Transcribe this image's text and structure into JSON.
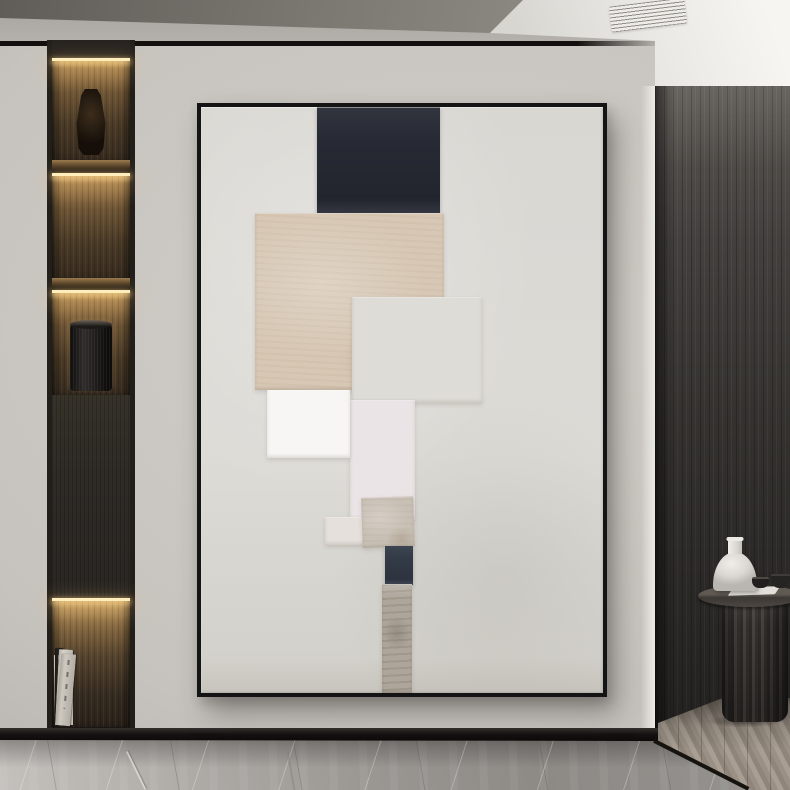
{
  "scene": {
    "type": "interior-photograph",
    "objects": [
      "framed-abstract-painting",
      "recessed-display-shelf",
      "dark-glass-vase",
      "black-cylinder-speaker",
      "book-row",
      "round-pedestal-side-table",
      "white-bottle-vase",
      "paper-sheet",
      "small-dark-bowls",
      "ceiling-air-vent"
    ]
  },
  "palette": {
    "wall": "#c9c6c1",
    "ceiling_dark": "#6e6b66",
    "ceiling_white": "#f2f0ed",
    "wood_wall": "#3c3936",
    "shelf_glow": "#d3ad6e",
    "baseboard": "#141210",
    "marble_floor": "#a09d99",
    "chevron_floor": "#9a9085",
    "frame": "#141414",
    "canvas": "#dbd9d4"
  },
  "painting": {
    "frame_color": "#141414",
    "canvas_color": "#dbd9d4",
    "blocks": [
      {
        "id": "navy-top",
        "left": 28.9,
        "top": 0.0,
        "width": 30.6,
        "height": 18.4,
        "color": "#272a34",
        "cls": "b-navy",
        "rot": 0
      },
      {
        "id": "beige-large",
        "left": 13.4,
        "top": 18.1,
        "width": 47.0,
        "height": 30.2,
        "color": "#d7c7b4",
        "cls": "b-paper",
        "rot": 0
      },
      {
        "id": "gray-square",
        "left": 37.6,
        "top": 32.4,
        "width": 32.3,
        "height": 18.1,
        "color": "#dedcd7",
        "cls": "",
        "rot": 0
      },
      {
        "id": "pale-rect",
        "left": 37.1,
        "top": 50.0,
        "width": 16.2,
        "height": 20.5,
        "color": "#eae4e6",
        "cls": "",
        "rot": 0
      },
      {
        "id": "white-square",
        "left": 16.4,
        "top": 48.3,
        "width": 20.6,
        "height": 11.6,
        "color": "#f7f6f4",
        "cls": "",
        "rot": 0
      },
      {
        "id": "small-pale",
        "left": 30.8,
        "top": 70.0,
        "width": 11.2,
        "height": 4.8,
        "color": "#e5e0dc",
        "cls": "",
        "rot": 0
      },
      {
        "id": "tan-square",
        "left": 40.0,
        "top": 66.6,
        "width": 12.9,
        "height": 8.6,
        "color": "#c8c0b5",
        "cls": "b-paper",
        "rot": -2
      },
      {
        "id": "navy-small",
        "left": 45.8,
        "top": 74.9,
        "width": 7.0,
        "height": 6.6,
        "color": "#333b47",
        "cls": "b-navy",
        "rot": 0
      },
      {
        "id": "stone-strip",
        "left": 45.0,
        "top": 81.4,
        "width": 7.5,
        "height": 18.6,
        "color": "#aea69b",
        "cls": "b-stone",
        "rot": 0
      }
    ]
  },
  "shelf_books": [
    {
      "w": 12,
      "h": 70,
      "color": "#e7e3da",
      "rot": -1,
      "spine": "light"
    },
    {
      "w": 18,
      "h": 74,
      "color": "#ded9cf",
      "rot": 0,
      "spine": "light"
    },
    {
      "w": 8,
      "h": 77,
      "color": "#24201c",
      "rot": 0,
      "spine": "dark"
    },
    {
      "w": 14,
      "h": 76,
      "color": "#d8d4ca",
      "rot": 3,
      "spine": "light"
    },
    {
      "w": 15,
      "h": 72,
      "color": "#cec9c0",
      "rot": 5,
      "spine": "light"
    }
  ]
}
